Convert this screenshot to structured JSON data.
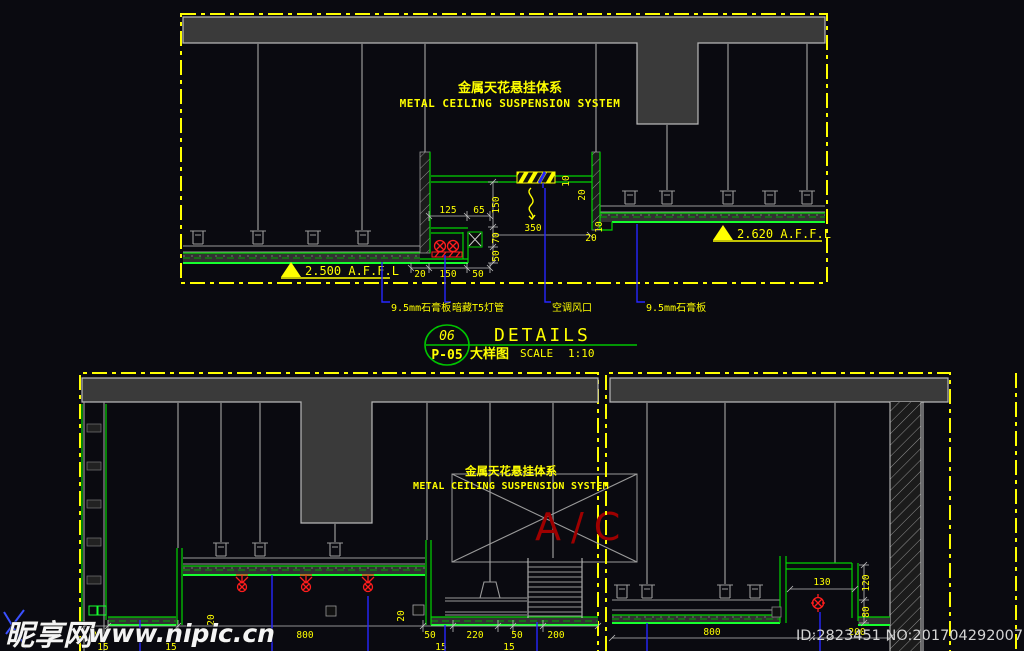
{
  "top": {
    "title_cn": "金属天花悬挂体系",
    "title_en": "METAL CEILING SUSPENSION SYSTEM",
    "level_left": "2.500 A.F.F.L",
    "level_right": "2.620 A.F.F.L",
    "labels": [
      "9.5mm石膏板",
      "暗藏T5灯管",
      "空调风口",
      "9.5mm石膏板"
    ],
    "dims": [
      "125",
      "65",
      "150",
      "70",
      "50",
      "350",
      "10",
      "20",
      "10",
      "20",
      "20",
      "150",
      "50"
    ]
  },
  "titleblock": {
    "num": "06",
    "sheet": "P-05",
    "title": "DETAILS",
    "cn": "大样图",
    "scale": "SCALE",
    "ratio": "1:10"
  },
  "bl": {
    "title_cn": "金属天花悬挂体系",
    "title_en": "METAL CEILING SUSPENSION SYSTEM",
    "ac": "A/C",
    "dims1": [
      "0",
      "800",
      "50",
      "220",
      "50",
      "200"
    ],
    "dims2": [
      "15",
      "15",
      "15",
      "15"
    ],
    "v20": [
      "20",
      "20"
    ]
  },
  "br": {
    "dims": [
      "130",
      "120",
      "80",
      "800",
      "200"
    ]
  },
  "wm": {
    "brand": "昵享网",
    "site": "www.nipic.cn",
    "id": "ID:2823451 NO:20170429200750603000"
  }
}
